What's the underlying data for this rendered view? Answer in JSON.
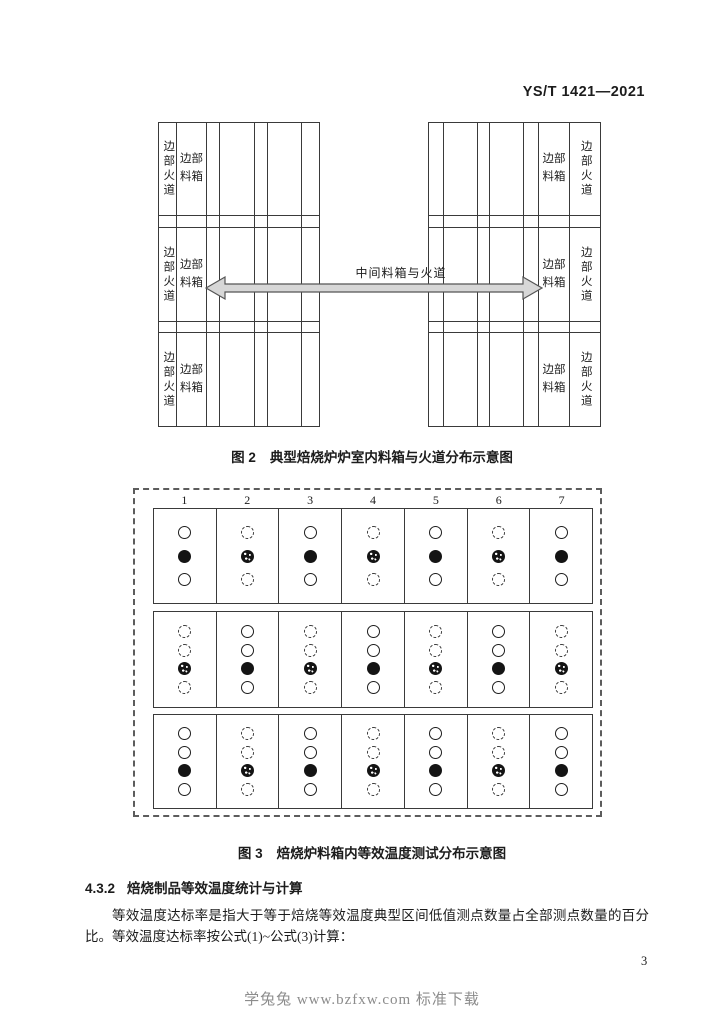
{
  "page": {
    "header": "YS/T 1421—2021",
    "page_number": "3",
    "footer_watermark": "学兔兔 www.bzfxw.com 标准下载"
  },
  "figure2": {
    "caption_label": "图 2",
    "caption_title": "典型焙烧炉炉室内料箱与火道分布示意图",
    "labels": {
      "edge_flue": "边部火道",
      "edge_box": "边部料箱",
      "middle": "中间料箱与火道"
    }
  },
  "figure3": {
    "caption_label": "图 3",
    "caption_title": "焙烧炉料箱内等效温度测试分布示意图",
    "column_numbers": [
      "1",
      "2",
      "3",
      "4",
      "5",
      "6",
      "7"
    ],
    "point_types": {
      "open": "solid-outline test point",
      "filled": "solid black test point",
      "dashed": "dashed-outline test point",
      "speckled": "speckled black test point"
    },
    "bands": [
      {
        "odd_columns": [
          "open",
          "filled",
          "open"
        ],
        "even_columns": [
          "dashed",
          "speckled",
          "dashed"
        ]
      },
      {
        "odd_columns": [
          "dashed",
          "dashed",
          "speckled",
          "dashed"
        ],
        "even_columns": [
          "open",
          "open",
          "filled",
          "open"
        ]
      },
      {
        "odd_columns": [
          "open",
          "open",
          "filled",
          "open"
        ],
        "even_columns": [
          "dashed",
          "dashed",
          "speckled",
          "dashed"
        ]
      }
    ]
  },
  "section": {
    "number": "4.3.2",
    "title": "焙烧制品等效温度统计与计算",
    "paragraph": "等效温度达标率是指大于等于焙烧等效温度典型区间低值测点数量占全部测点数量的百分比。等效温度达标率按公式(1)~公式(3)计算："
  }
}
